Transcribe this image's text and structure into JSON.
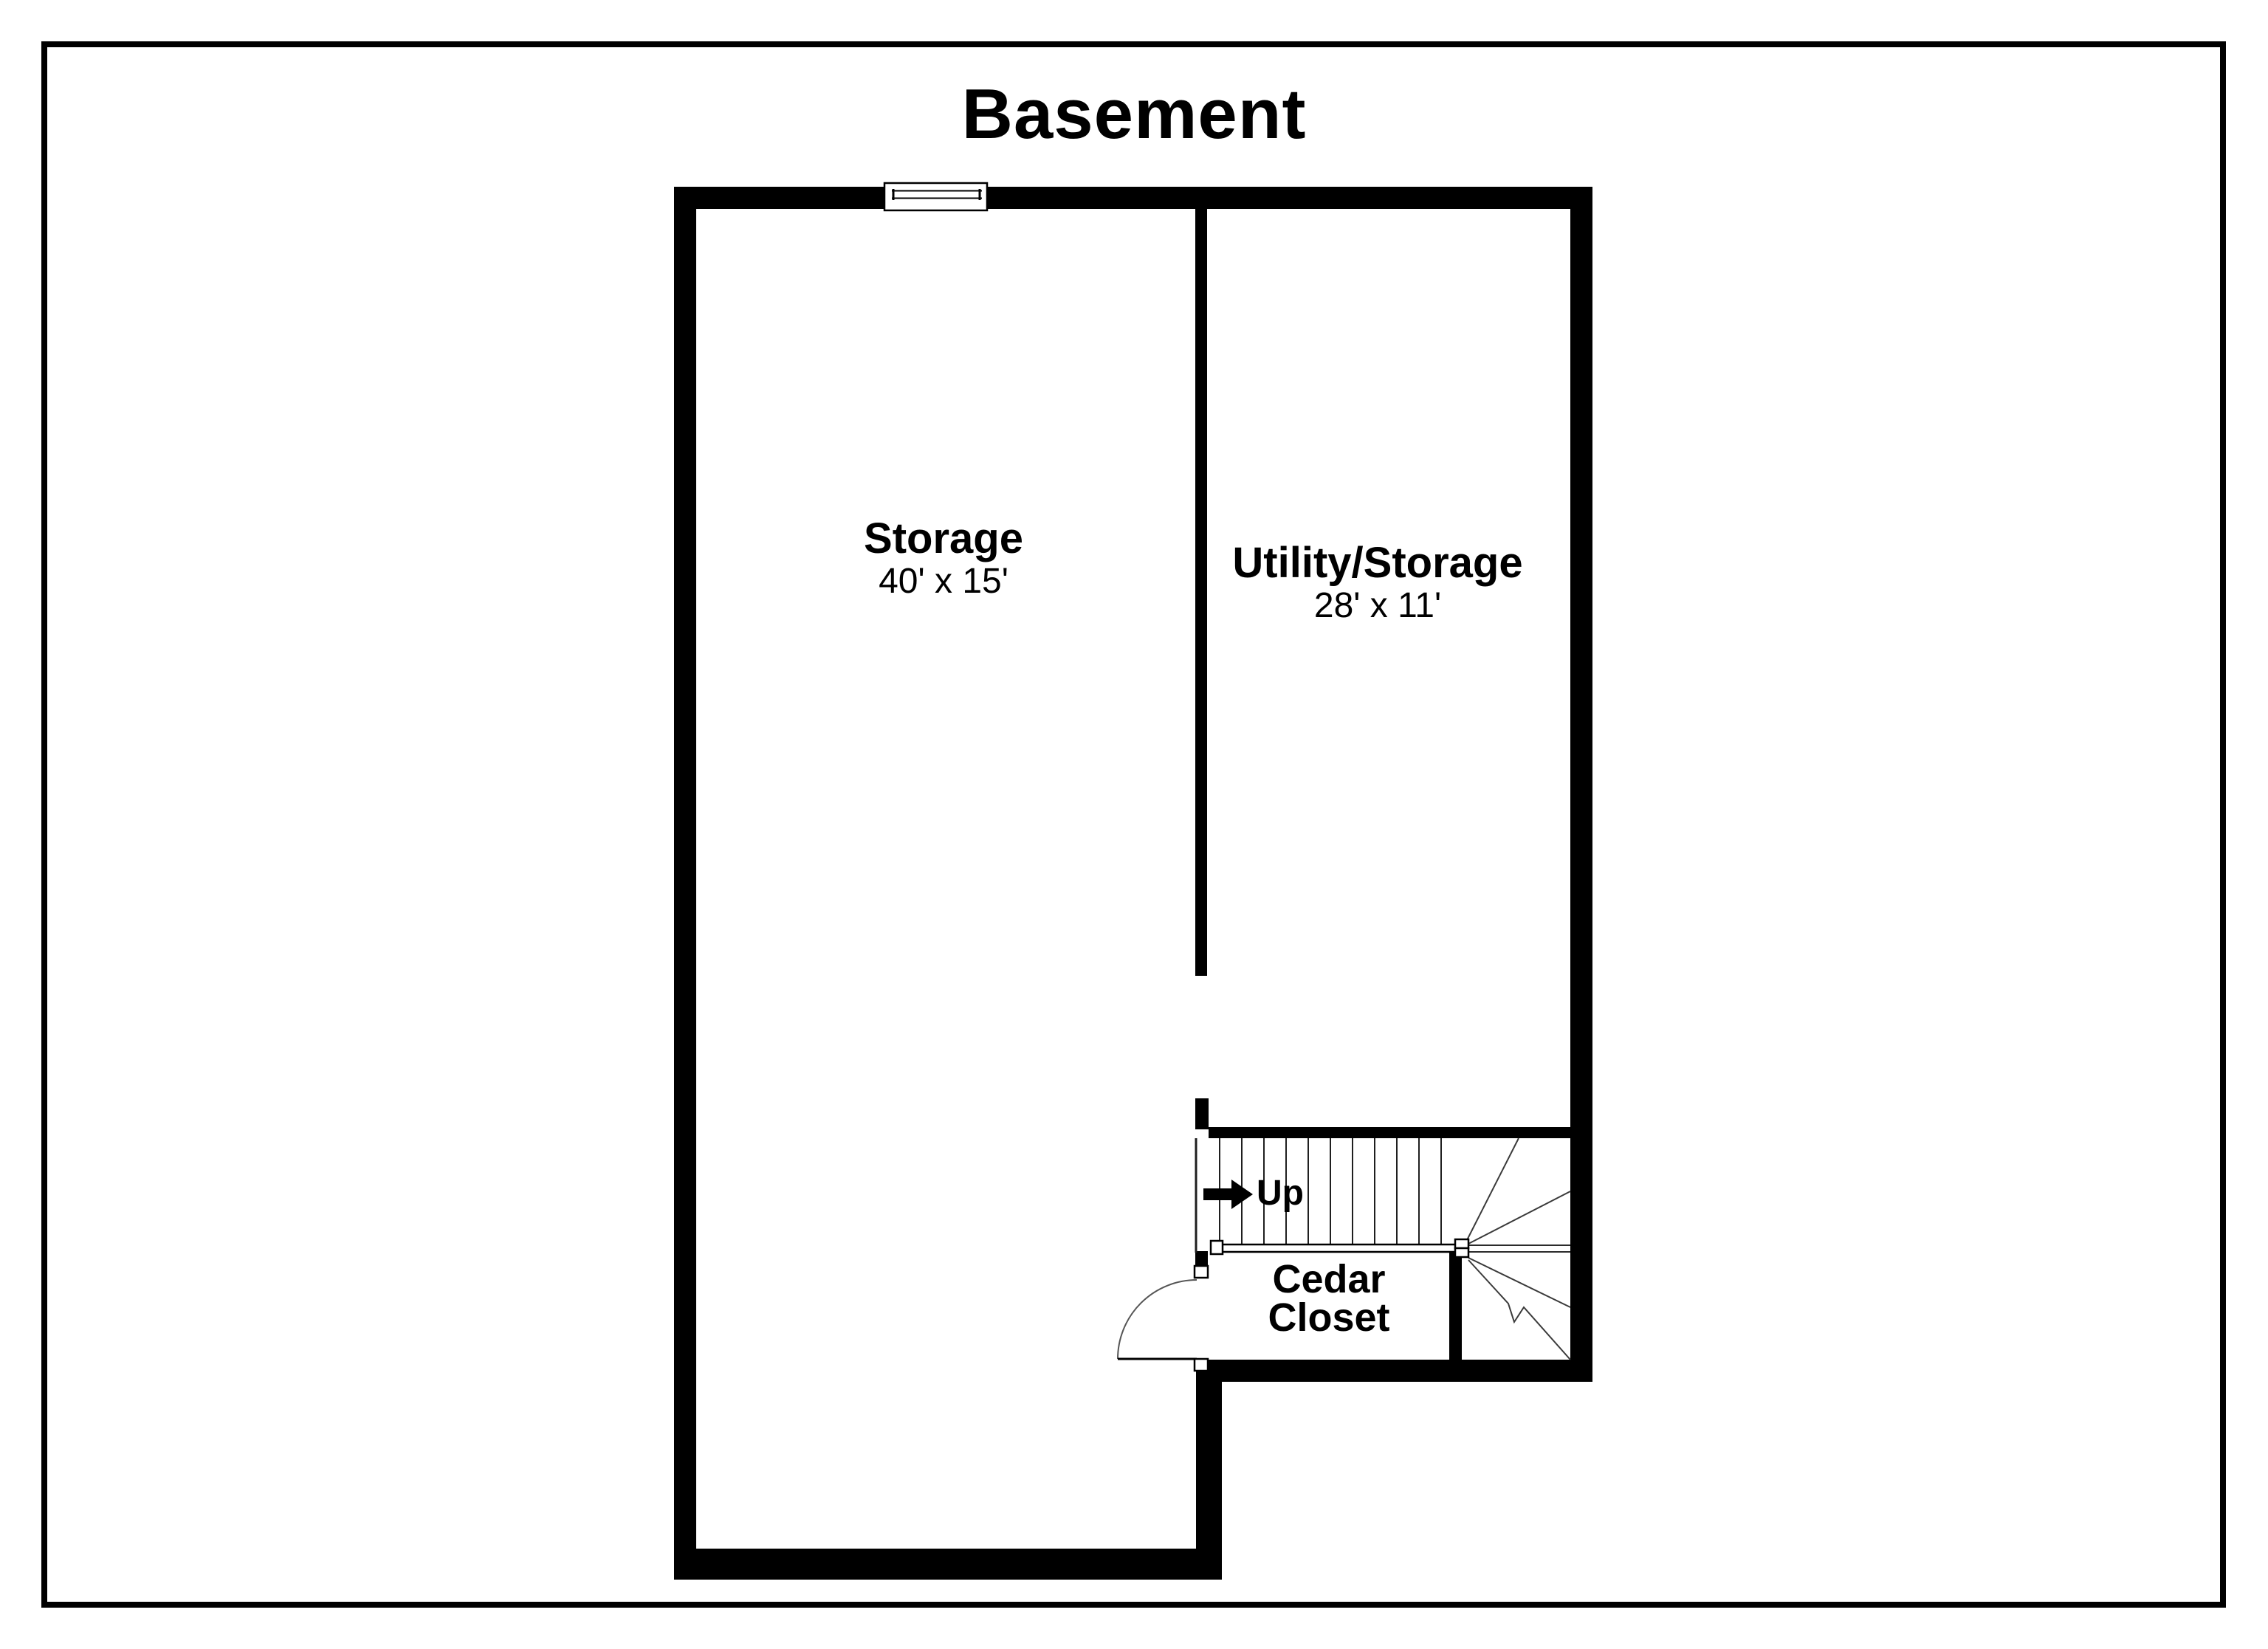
{
  "page": {
    "title": "Basement",
    "colors": {
      "background": "#ffffff",
      "walls": "#000000",
      "thin_lines": "#2b2b2b",
      "border": "#000000"
    }
  },
  "floor_plan": {
    "rooms": [
      {
        "name": "Storage",
        "dimensions": "40' x 15'"
      },
      {
        "name": "Utility/Storage",
        "dimensions": "28' x 11'"
      },
      {
        "name": "Cedar Closet"
      }
    ],
    "stairs": {
      "label": "Up",
      "icon": "up-arrow-icon"
    },
    "features": {
      "window": "window-icon",
      "door": "door-swing-icon"
    }
  }
}
